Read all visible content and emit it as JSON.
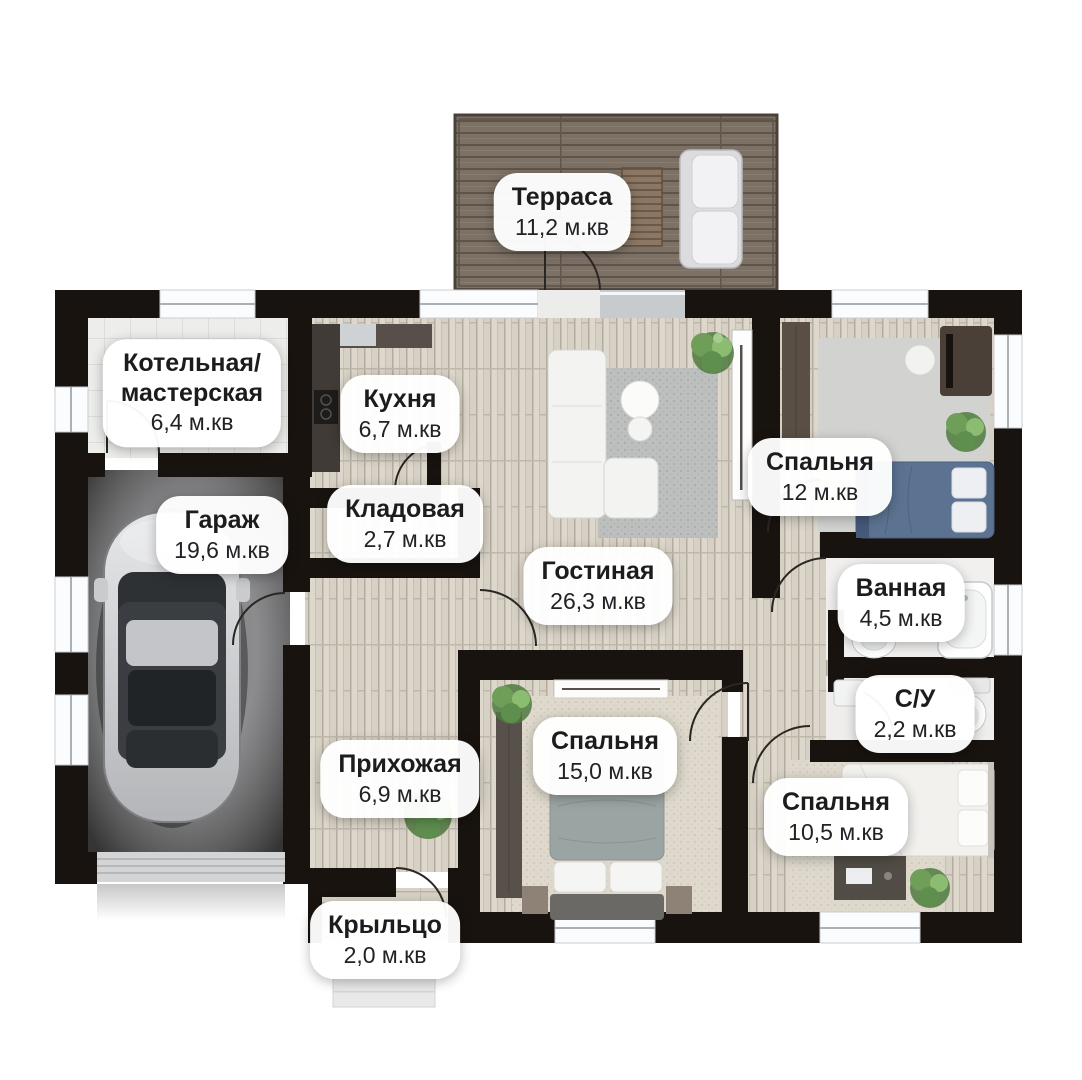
{
  "palette": {
    "wall": "#18130f",
    "label_background": "#ffffff",
    "label_text": "#1c1c1e",
    "terrace_deck": "#7b6f64",
    "wood_floor": "#d7d1c5",
    "garage_floor": "#8c8c8e",
    "plant_green": "#6f9e58",
    "bed_blue": "#5b7391"
  },
  "plan": {
    "unit": "м.кв",
    "rooms": [
      {
        "key": "terrace",
        "name": "Терраса",
        "area": "11,2 м.кв"
      },
      {
        "key": "boiler",
        "name": "Котельная/\nмастерская",
        "area": "6,4 м.кв"
      },
      {
        "key": "kitchen",
        "name": "Кухня",
        "area": "6,7 м.кв"
      },
      {
        "key": "garage",
        "name": "Гараж",
        "area": "19,6 м.кв"
      },
      {
        "key": "storage",
        "name": "Кладовая",
        "area": "2,7 м.кв"
      },
      {
        "key": "living",
        "name": "Гостиная",
        "area": "26,3 м.кв"
      },
      {
        "key": "bedroom1",
        "name": "Спальня",
        "area": "12 м.кв"
      },
      {
        "key": "bathroom",
        "name": "Ванная",
        "area": "4,5 м.кв"
      },
      {
        "key": "wc",
        "name": "С/У",
        "area": "2,2 м.кв"
      },
      {
        "key": "hallway",
        "name": "Прихожая",
        "area": "6,9 м.кв"
      },
      {
        "key": "bedroom2",
        "name": "Спальня",
        "area": "15,0 м.кв"
      },
      {
        "key": "bedroom3",
        "name": "Спальня",
        "area": "10,5 м.кв"
      },
      {
        "key": "porch",
        "name": "Крыльцо",
        "area": "2,0 м.кв"
      }
    ]
  }
}
